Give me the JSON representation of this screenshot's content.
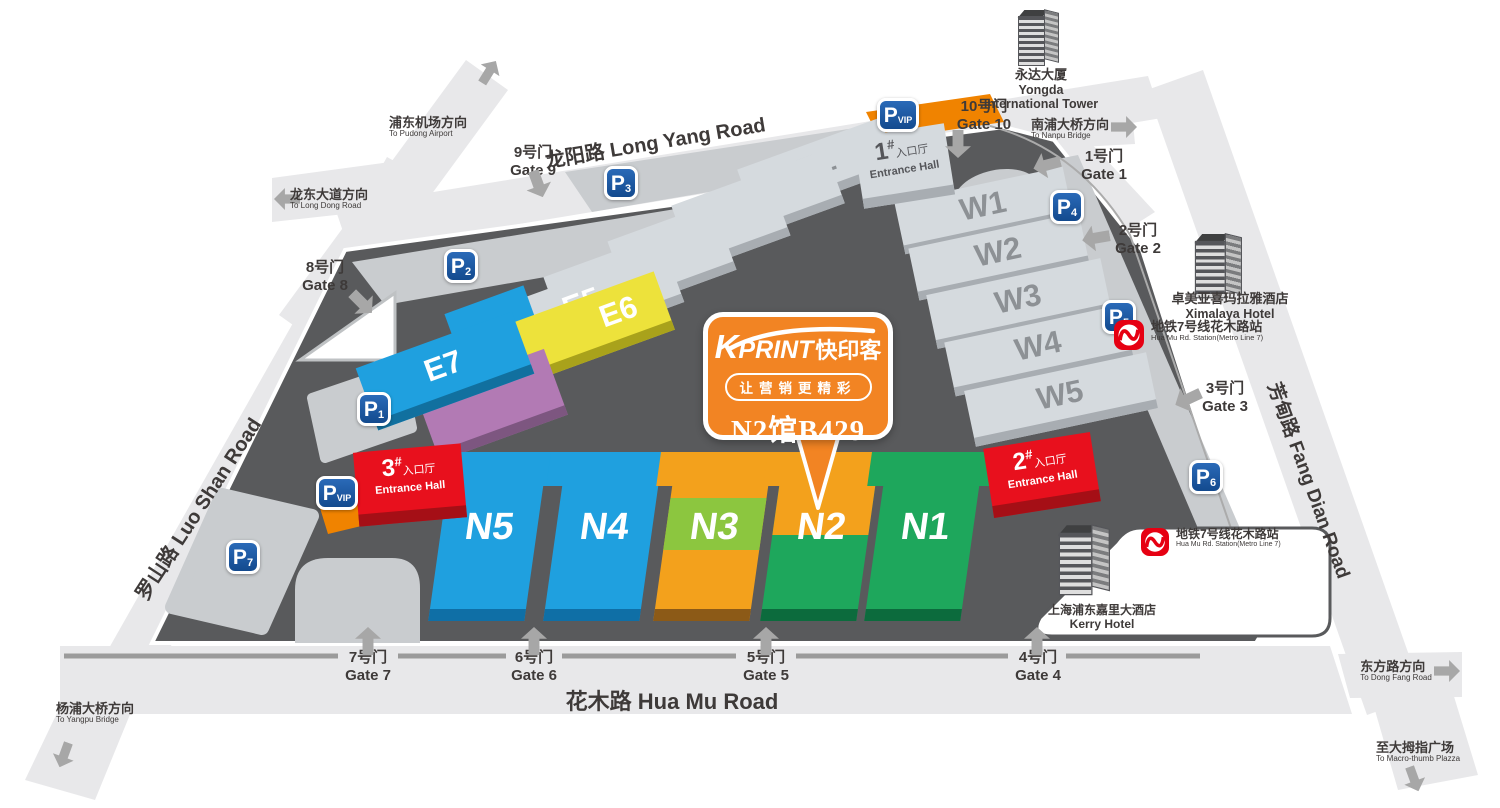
{
  "map": {
    "roads": {
      "long_yang": "龙阳路 Long Yang Road",
      "hua_mu": "花木路 Hua Mu Road",
      "luo_shan": "罗山路 Luo Shan Road",
      "fang_dian": "芳甸路 Fang Dian Road"
    },
    "directions": {
      "pudong": {
        "cn": "浦东机场方向",
        "en": "To Pudong Airport"
      },
      "longdong": {
        "cn": "龙东大道方向",
        "en": "To Long Dong Road"
      },
      "nanpu": {
        "cn": "南浦大桥方向",
        "en": "To Nanpu Bridge"
      },
      "yangpu": {
        "cn": "杨浦大桥方向",
        "en": "To Yangpu Bridge"
      },
      "dongfang": {
        "cn": "东方路方向",
        "en": "To Dong Fang Road"
      },
      "macrothumb": {
        "cn": "至大拇指广场",
        "en": "To Macro-thumb Plazza"
      }
    },
    "gates": {
      "g1": {
        "cn": "1号门",
        "en": "Gate 1"
      },
      "g2": {
        "cn": "2号门",
        "en": "Gate 2"
      },
      "g3": {
        "cn": "3号门",
        "en": "Gate 3"
      },
      "g4": {
        "cn": "4号门",
        "en": "Gate 4"
      },
      "g5": {
        "cn": "5号门",
        "en": "Gate 5"
      },
      "g6": {
        "cn": "6号门",
        "en": "Gate 6"
      },
      "g7": {
        "cn": "7号门",
        "en": "Gate 7"
      },
      "g8": {
        "cn": "8号门",
        "en": "Gate 8"
      },
      "g9": {
        "cn": "9号门",
        "en": "Gate 9"
      },
      "g10": {
        "cn": "10号门",
        "en": "Gate 10"
      }
    },
    "halls": {
      "e": [
        "E1",
        "E2",
        "E3",
        "E4",
        "E5",
        "E6",
        "E7"
      ],
      "w": [
        "W1",
        "W2",
        "W3",
        "W4",
        "W5"
      ],
      "n": [
        "N1",
        "N2",
        "N3",
        "N4",
        "N5"
      ]
    },
    "entrances": {
      "e1": {
        "num": "1",
        "hash": "#",
        "cn": "入口厅",
        "en": "Entrance Hall"
      },
      "e2": {
        "num": "2",
        "hash": "#",
        "cn": "入口厅",
        "en": "Entrance Hall"
      },
      "e3": {
        "num": "3",
        "hash": "#",
        "cn": "入口厅",
        "en": "Entrance Hall"
      }
    },
    "parking": {
      "letter": "P",
      "nums": [
        "1",
        "2",
        "3",
        "4",
        "5",
        "6",
        "7"
      ],
      "vip": "VIP"
    },
    "metro": {
      "cn": "地铁7号线花木路站",
      "en": "Hua Mu Rd. Station(Metro Line 7)"
    },
    "buildings": {
      "yongda": {
        "cn": "永达大厦",
        "en1": "Yongda",
        "en2": "International Tower"
      },
      "ximalaya": {
        "cn": "卓美亚喜玛拉雅酒店",
        "en": "Ximalaya Hotel"
      },
      "kerry": {
        "cn": "上海浦东嘉里大酒店",
        "en": "Kerry Hotel"
      }
    }
  },
  "callout": {
    "brand_k": "K",
    "brand_rest": "PRINT",
    "brand_cn": "快印客",
    "slogan": "让营销更精彩",
    "booth": "N2馆B429"
  },
  "colors": {
    "hall_blue": "#1FA0DF",
    "hall_green": "#1EA75C",
    "hall_orange": "#F3A11C",
    "hall_yellow": "#EDE23B",
    "hall_purple": "#B27AB4",
    "entrance_red": "#E8101D",
    "parking_blue": "#1857A4",
    "vip_orange": "#F08300",
    "metro_red": "#E60012",
    "ground_dark": "#595A5C",
    "road_gray": "#E8E8EA",
    "callout_orange": "#F28423"
  }
}
